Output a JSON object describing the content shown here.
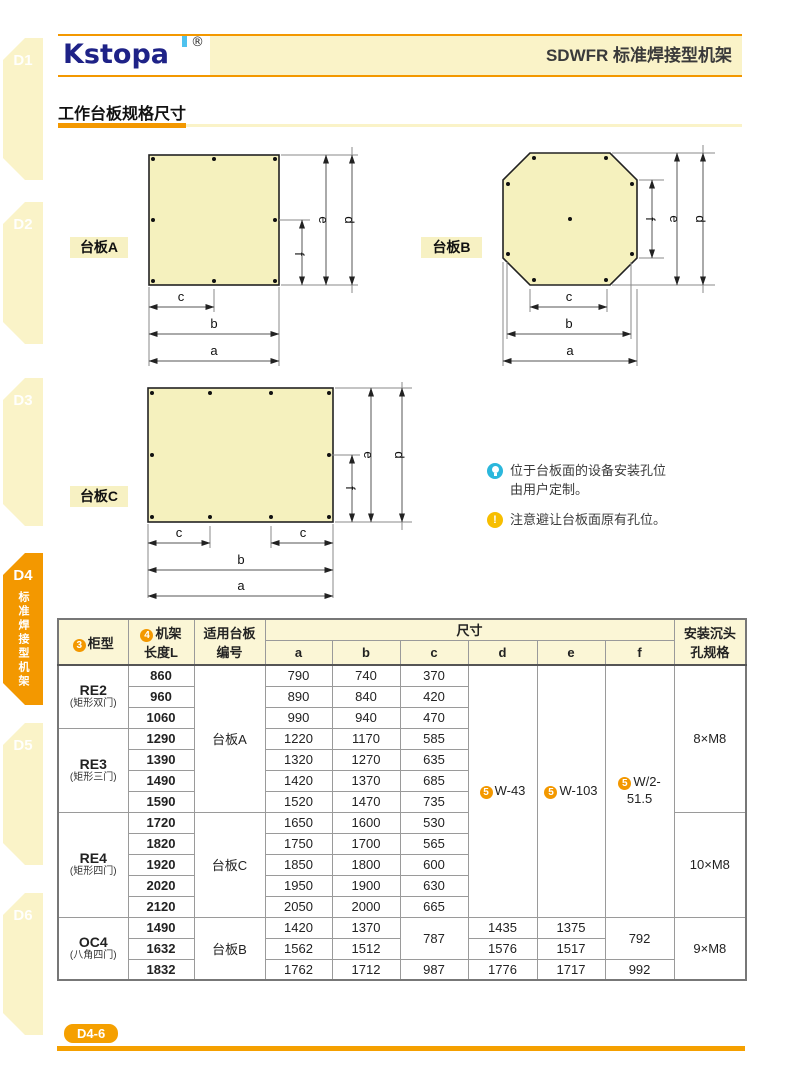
{
  "sidebar": {
    "tabs": [
      {
        "label": "D1"
      },
      {
        "label": "D2"
      },
      {
        "label": "D3"
      },
      {
        "label": "D4",
        "subtitle": "标准焊接型机架"
      },
      {
        "label": "D5"
      },
      {
        "label": "D6"
      }
    ]
  },
  "header": {
    "logo": "Kstopa",
    "logo_reg": "®",
    "title": "SDWFR 标准焊接型机架"
  },
  "section": {
    "title": "工作台板规格尺寸"
  },
  "diagrams": {
    "dims": {
      "a": "a",
      "b": "b",
      "c": "c",
      "d": "d",
      "e": "e",
      "f": "f"
    },
    "plate_a_label": "台板A",
    "plate_b_label": "台板B",
    "plate_c_label": "台板C"
  },
  "notes": {
    "tip_line1": "位于台板面的设备安装孔位",
    "tip_line2": "由用户定制。",
    "warning": "注意避让台板面原有孔位。"
  },
  "table": {
    "header": {
      "cabinet_badge": "3",
      "cabinet": "柜型",
      "length_badge": "4",
      "length_line1": "机架",
      "length_line2": "长度L",
      "plate_line1": "适用台板",
      "plate_line2": "编号",
      "size": "尺寸",
      "size_cols": [
        "a",
        "b",
        "c",
        "d",
        "e",
        "f"
      ],
      "hole_line1": "安装沉头",
      "hole_line2": "孔规格"
    },
    "cabinets": [
      {
        "name": "RE2",
        "sub": "(矩形双门)"
      },
      {
        "name": "RE3",
        "sub": "(矩形三门)"
      },
      {
        "name": "RE4",
        "sub": "(矩形四门)"
      },
      {
        "name": "OC4",
        "sub": "(八角四门)"
      }
    ],
    "plates": [
      "台板A",
      "台板C",
      "台板B"
    ],
    "holes": [
      "8×M8",
      "10×M8",
      "9×M8"
    ],
    "def_merged": {
      "badge": "5",
      "d": "W-43",
      "e": "W-103",
      "f": "W/2-51.5"
    },
    "rows": [
      {
        "len": "860",
        "a": "790",
        "b": "740",
        "c": "370"
      },
      {
        "len": "960",
        "a": "890",
        "b": "840",
        "c": "420"
      },
      {
        "len": "1060",
        "a": "990",
        "b": "940",
        "c": "470"
      },
      {
        "len": "1290",
        "a": "1220",
        "b": "1170",
        "c": "585"
      },
      {
        "len": "1390",
        "a": "1320",
        "b": "1270",
        "c": "635"
      },
      {
        "len": "1490",
        "a": "1420",
        "b": "1370",
        "c": "685"
      },
      {
        "len": "1590",
        "a": "1520",
        "b": "1470",
        "c": "735"
      },
      {
        "len": "1720",
        "a": "1650",
        "b": "1600",
        "c": "530"
      },
      {
        "len": "1820",
        "a": "1750",
        "b": "1700",
        "c": "565"
      },
      {
        "len": "1920",
        "a": "1850",
        "b": "1800",
        "c": "600"
      },
      {
        "len": "2020",
        "a": "1950",
        "b": "1900",
        "c": "630"
      },
      {
        "len": "2120",
        "a": "2050",
        "b": "2000",
        "c": "665"
      },
      {
        "len": "1490",
        "a": "1420",
        "b": "1370",
        "c": "787",
        "d": "1435",
        "e": "1375",
        "f": "792"
      },
      {
        "len": "1632",
        "a": "1562",
        "b": "1512",
        "d": "1576",
        "e": "1517"
      },
      {
        "len": "1832",
        "a": "1762",
        "b": "1712",
        "c": "987",
        "d": "1776",
        "e": "1717",
        "f": "992"
      }
    ]
  },
  "footer": {
    "page": "D4-6"
  },
  "colors": {
    "accent_orange": "#F39800",
    "cream": "#FAF3C8",
    "plate_fill": "#F5F1BE",
    "logo_navy": "#1E2287",
    "logo_blue": "#4FC2EE",
    "tip_cyan": "#2BB7DC",
    "warn_yellow": "#F7BE00",
    "table_header_bg": "#FBF6D6"
  }
}
